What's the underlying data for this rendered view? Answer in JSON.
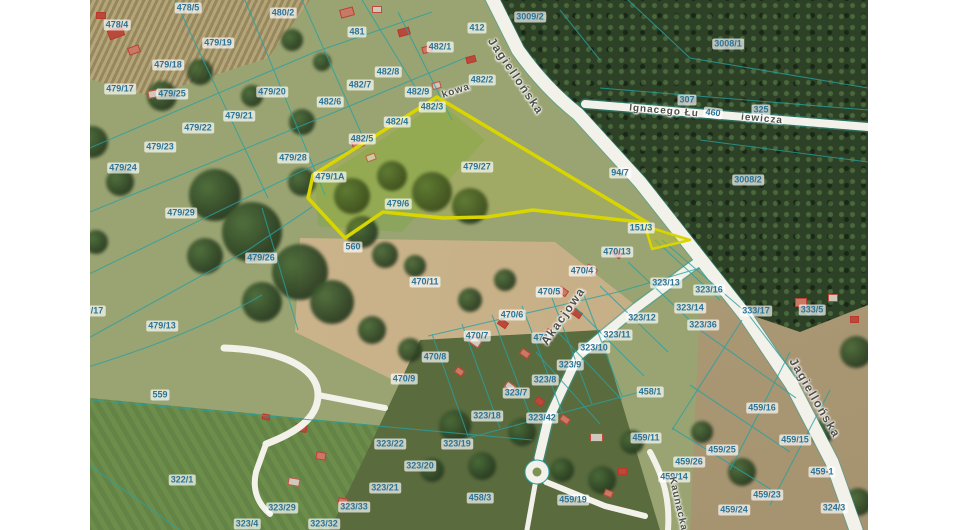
{
  "map": {
    "highlighted_parcel": "479/27",
    "colors": {
      "highlight_outline": "#d9d500",
      "boundary_line": "#2aa0a0",
      "label_text": "#2d7396",
      "road_fill": "#f3f2ea",
      "forest": "#2c4126"
    },
    "parcel_labels": [
      {
        "t": "478/5",
        "x": 188,
        "y": 8
      },
      {
        "t": "480/2",
        "x": 283,
        "y": 13
      },
      {
        "t": "3009/2",
        "x": 530,
        "y": 17
      },
      {
        "t": "478/4",
        "x": 117,
        "y": 25
      },
      {
        "t": "412",
        "x": 477,
        "y": 28
      },
      {
        "t": "481",
        "x": 357,
        "y": 32
      },
      {
        "t": "3008/1",
        "x": 728,
        "y": 44
      },
      {
        "t": "479/19",
        "x": 218,
        "y": 43
      },
      {
        "t": "482/1",
        "x": 440,
        "y": 47
      },
      {
        "t": "479/18",
        "x": 168,
        "y": 65
      },
      {
        "t": "482/8",
        "x": 388,
        "y": 72
      },
      {
        "t": "482/2",
        "x": 482,
        "y": 80
      },
      {
        "t": "482/7",
        "x": 360,
        "y": 85
      },
      {
        "t": "479/17",
        "x": 120,
        "y": 89
      },
      {
        "t": "482/9",
        "x": 418,
        "y": 92
      },
      {
        "t": "479/25",
        "x": 172,
        "y": 94
      },
      {
        "t": "479/20",
        "x": 272,
        "y": 92
      },
      {
        "t": "307",
        "x": 687,
        "y": 100
      },
      {
        "t": "482/6",
        "x": 330,
        "y": 102
      },
      {
        "t": "482/3",
        "x": 432,
        "y": 107
      },
      {
        "t": "325",
        "x": 761,
        "y": 110
      },
      {
        "t": "460",
        "x": 713,
        "y": 113,
        "r": 7
      },
      {
        "t": "479/21",
        "x": 239,
        "y": 116
      },
      {
        "t": "482/4",
        "x": 397,
        "y": 122
      },
      {
        "t": "479/22",
        "x": 198,
        "y": 128
      },
      {
        "t": "482/5",
        "x": 362,
        "y": 139
      },
      {
        "t": "479/23",
        "x": 160,
        "y": 147
      },
      {
        "t": "479/28",
        "x": 293,
        "y": 158
      },
      {
        "t": "479/27",
        "x": 477,
        "y": 167
      },
      {
        "t": "479/24",
        "x": 123,
        "y": 168
      },
      {
        "t": "94/7",
        "x": 620,
        "y": 173
      },
      {
        "t": "479/1A",
        "x": 330,
        "y": 177
      },
      {
        "t": "3008/2",
        "x": 748,
        "y": 180
      },
      {
        "t": "479/6",
        "x": 398,
        "y": 204
      },
      {
        "t": "479/29",
        "x": 181,
        "y": 213
      },
      {
        "t": "151/3",
        "x": 641,
        "y": 228
      },
      {
        "t": "560",
        "x": 353,
        "y": 247
      },
      {
        "t": "470/13",
        "x": 617,
        "y": 252
      },
      {
        "t": "479/26",
        "x": 261,
        "y": 258
      },
      {
        "t": "470/4",
        "x": 582,
        "y": 271
      },
      {
        "t": "470/11",
        "x": 425,
        "y": 282
      },
      {
        "t": "323/13",
        "x": 666,
        "y": 283
      },
      {
        "t": "323/16",
        "x": 709,
        "y": 290
      },
      {
        "t": "470/5",
        "x": 549,
        "y": 292
      },
      {
        "t": "323/14",
        "x": 690,
        "y": 308
      },
      {
        "t": "333/17",
        "x": 756,
        "y": 311
      },
      {
        "t": "333/5",
        "x": 812,
        "y": 310
      },
      {
        "t": "/17",
        "x": 97,
        "y": 311
      },
      {
        "t": "470/6",
        "x": 512,
        "y": 315
      },
      {
        "t": "323/12",
        "x": 642,
        "y": 318
      },
      {
        "t": "323/36",
        "x": 703,
        "y": 325
      },
      {
        "t": "479/13",
        "x": 162,
        "y": 326
      },
      {
        "t": "323/11",
        "x": 617,
        "y": 335
      },
      {
        "t": "470/7",
        "x": 477,
        "y": 336
      },
      {
        "t": "471",
        "x": 541,
        "y": 338
      },
      {
        "t": "323/10",
        "x": 594,
        "y": 348
      },
      {
        "t": "470/8",
        "x": 435,
        "y": 357
      },
      {
        "t": "323/9",
        "x": 570,
        "y": 365
      },
      {
        "t": "470/9",
        "x": 404,
        "y": 379
      },
      {
        "t": "323/8",
        "x": 545,
        "y": 380
      },
      {
        "t": "458/1",
        "x": 650,
        "y": 392
      },
      {
        "t": "323/7",
        "x": 516,
        "y": 393
      },
      {
        "t": "559",
        "x": 160,
        "y": 395
      },
      {
        "t": "459/16",
        "x": 762,
        "y": 408
      },
      {
        "t": "323/18",
        "x": 487,
        "y": 416
      },
      {
        "t": "323/42",
        "x": 542,
        "y": 418
      },
      {
        "t": "459/11",
        "x": 646,
        "y": 438
      },
      {
        "t": "459/15",
        "x": 795,
        "y": 440
      },
      {
        "t": "323/22",
        "x": 390,
        "y": 444
      },
      {
        "t": "323/19",
        "x": 457,
        "y": 444
      },
      {
        "t": "459/25",
        "x": 722,
        "y": 450
      },
      {
        "t": "459/26",
        "x": 689,
        "y": 462
      },
      {
        "t": "323/20",
        "x": 420,
        "y": 466
      },
      {
        "t": "459-1",
        "x": 822,
        "y": 472
      },
      {
        "t": "459/14",
        "x": 674,
        "y": 477
      },
      {
        "t": "322/1",
        "x": 182,
        "y": 480
      },
      {
        "t": "323/21",
        "x": 385,
        "y": 488
      },
      {
        "t": "459/23",
        "x": 767,
        "y": 495
      },
      {
        "t": "458/3",
        "x": 480,
        "y": 498
      },
      {
        "t": "459/19",
        "x": 573,
        "y": 500
      },
      {
        "t": "323/33",
        "x": 354,
        "y": 507
      },
      {
        "t": "323/29",
        "x": 282,
        "y": 508
      },
      {
        "t": "324/3",
        "x": 834,
        "y": 508
      },
      {
        "t": "459/24",
        "x": 734,
        "y": 510
      },
      {
        "t": "323/32",
        "x": 324,
        "y": 524
      },
      {
        "t": "323/4",
        "x": 247,
        "y": 524
      }
    ],
    "street_labels": [
      {
        "t": "Jagiellońska",
        "x": 516,
        "y": 76,
        "r": 56
      },
      {
        "t": "Jagiellońska",
        "x": 815,
        "y": 398,
        "r": 60
      },
      {
        "t": "Ignacego Łu",
        "x": 664,
        "y": 111,
        "r": 5,
        "small": true
      },
      {
        "t": "iewicza",
        "x": 762,
        "y": 119,
        "r": 5,
        "small": true
      },
      {
        "t": "kowa",
        "x": 456,
        "y": 91,
        "r": -18,
        "small": true
      },
      {
        "t": "Akacjowa",
        "x": 563,
        "y": 316,
        "r": -55
      },
      {
        "t": "Kaunacka",
        "x": 678,
        "y": 504,
        "r": 77,
        "small": true
      }
    ]
  }
}
